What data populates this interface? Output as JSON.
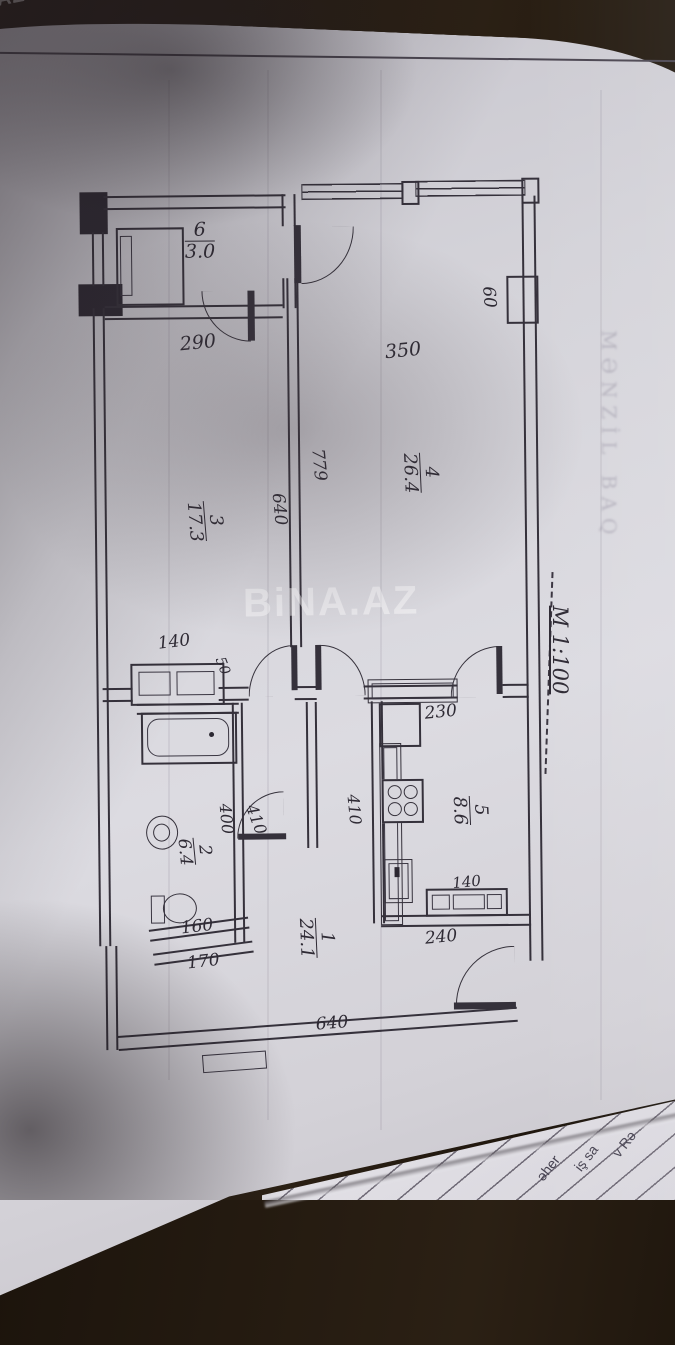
{
  "document": {
    "scale_label": "M 1:100"
  },
  "watermark": {
    "main": "BiNA.AZ",
    "corner": "A.AZ",
    "bleed_text": "MƏNZİL BAQ"
  },
  "rooms": [
    {
      "num": "1",
      "area": "24.1"
    },
    {
      "num": "2",
      "area": "6.4"
    },
    {
      "num": "3",
      "area": "17.3"
    },
    {
      "num": "4",
      "area": "26.4"
    },
    {
      "num": "5",
      "area": "8.6"
    },
    {
      "num": "6",
      "area": "3.0"
    }
  ],
  "dims": {
    "d290": "290",
    "d350": "350",
    "d60": "60",
    "d779": "779",
    "d640_mid": "640",
    "d140_bath": "140",
    "d50": "50",
    "d230": "230",
    "d410_kitchen": "410",
    "d400": "400",
    "d410_door": "410",
    "d160": "160",
    "d170": "170",
    "d240": "240",
    "d140_kitchen": "140",
    "d640_bottom": "640"
  },
  "table_fragments": {
    "f1": "əher",
    "f2": "iş sa",
    "f3": "v Rə"
  },
  "colors": {
    "paper": "#d6d5db",
    "line": "#35313b",
    "background": "#2b2014"
  }
}
